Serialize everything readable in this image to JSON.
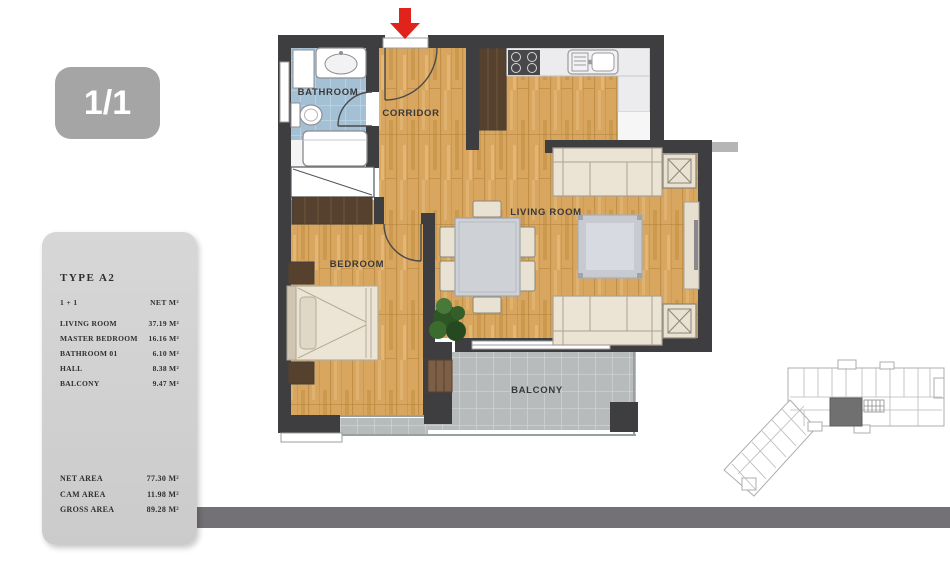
{
  "page_indicator": "1/1",
  "plan_labels": {
    "bathroom": "BATHROOM",
    "corridor": "CORRIDOR",
    "bedroom": "BEDROOM",
    "living_room": "LIVING ROOM",
    "balcony": "BALCONY"
  },
  "info_panel": {
    "title": "TYPE A2",
    "columns": {
      "left": "1 + 1",
      "right": "NET M²"
    },
    "rows": [
      {
        "label": "LIVING ROOM",
        "value": "37.19 M²"
      },
      {
        "label": "MASTER BEDROOM",
        "value": "16.16 M²"
      },
      {
        "label": "BATHROOM 01",
        "value": "6.10 M²"
      },
      {
        "label": "HALL",
        "value": "8.38 M²"
      },
      {
        "label": "BALCONY",
        "value": "9.47 M²"
      }
    ],
    "totals": [
      {
        "label": "NET AREA",
        "value": "77.30 M²"
      },
      {
        "label": "CAM AREA",
        "value": "11.98 M²"
      },
      {
        "label": "GROSS AREA",
        "value": "89.28 M²"
      }
    ]
  },
  "colors": {
    "entrance_arrow": "#e0241c",
    "walls": "#3e3e40",
    "wood_floor": "#d8a65f",
    "bathroom_tile": "#a4c0d4",
    "balcony_tile": "#b8bbbb",
    "panel_bg": "#d2d2d2",
    "badge_bg": "#a5a5a5",
    "bottom_bar": "#747176",
    "site_plan_highlight": "#707070"
  }
}
